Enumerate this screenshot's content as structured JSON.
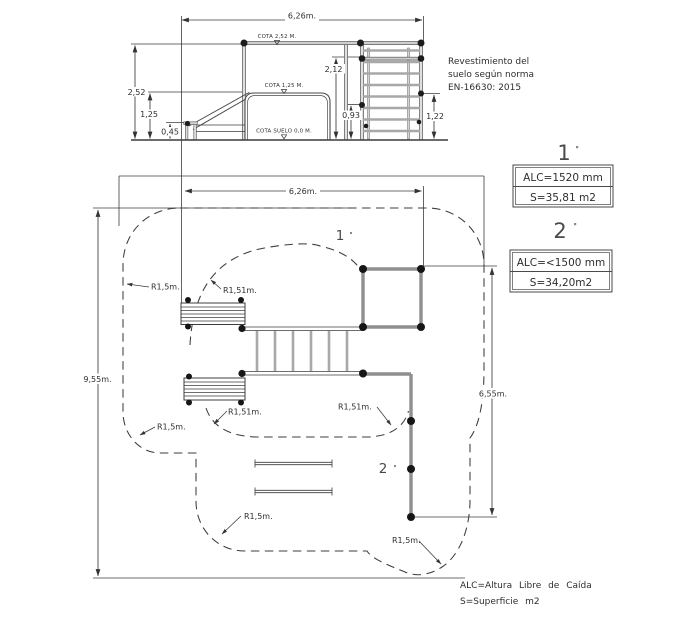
{
  "elevation": {
    "dims": {
      "width": "6,26m.",
      "total_height": "2,52",
      "mid_height": "1,25",
      "platform_height": "0,45",
      "tower_height": "2,12",
      "bar_low": "0,93",
      "bar_right": "1,22"
    },
    "cotas": {
      "top": "COTA 2,52 M.",
      "mid": "COTA 1,25 M.",
      "ground": "COTA SUELO 0,0 M."
    }
  },
  "note": {
    "line1": "Revestimiento del",
    "line2": "suelo según norma",
    "line3": "EN-16630: 2015"
  },
  "zones": {
    "zone1": {
      "marker": "1",
      "alc": "ALC=1520 mm",
      "surface": "S=35,81 m2"
    },
    "zone2": {
      "marker": "2",
      "alc": "ALC=<1500 mm",
      "surface": "S=34,20m2"
    }
  },
  "plan": {
    "dims": {
      "width": "6,26m.",
      "height": "9,55m.",
      "right_height": "6,55m."
    },
    "zone1_marker": "1",
    "zone2_marker": "2",
    "r15": "R1,5m.",
    "r151": "R1,51m."
  },
  "legend": {
    "alc": "ALC=Altura Libre de Caída",
    "s": "S=Superficie m2"
  }
}
